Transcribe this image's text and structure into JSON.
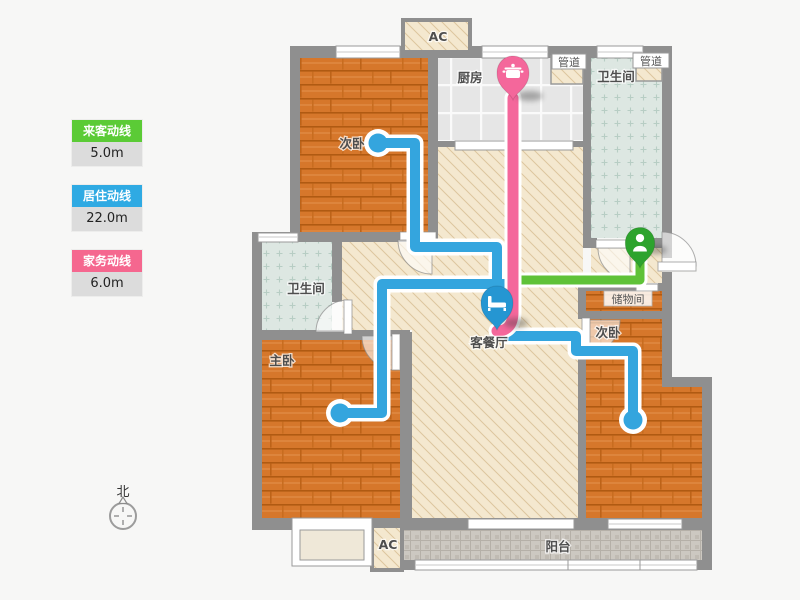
{
  "legend": {
    "items": [
      {
        "label": "来客动线",
        "value": "5.0m",
        "color": "#5bcb36"
      },
      {
        "label": "居住动线",
        "value": "22.0m",
        "color": "#2faae3"
      },
      {
        "label": "家务动线",
        "value": "6.0m",
        "color": "#f5678f"
      }
    ]
  },
  "compass": {
    "label": "北"
  },
  "rooms": {
    "bedroom_top": "次卧",
    "kitchen": "厨房",
    "duct": "管道",
    "bath": "卫生间",
    "storage": "储物间",
    "bedroom_right": "次卧",
    "living": "客餐厅",
    "master": "主卧",
    "balcony": "阳台",
    "ac": "AC"
  },
  "routes": {
    "guest": {
      "name": "来客动线",
      "length": "5.0m",
      "color": "#5fc238"
    },
    "living": {
      "name": "居住动线",
      "length": "22.0m",
      "color": "#34a5de"
    },
    "chore": {
      "name": "家务动线",
      "length": "6.0m",
      "color": "#f4679b"
    }
  },
  "pins": {
    "entry_icon": "person-icon",
    "living_icon": "bed-icon",
    "kitchen_icon": "pot-icon"
  },
  "colors": {
    "wall": "#8f8f8f",
    "pin_green": "#2da32d",
    "pin_blue": "#2596d2",
    "pin_pink": "#f4679b"
  }
}
